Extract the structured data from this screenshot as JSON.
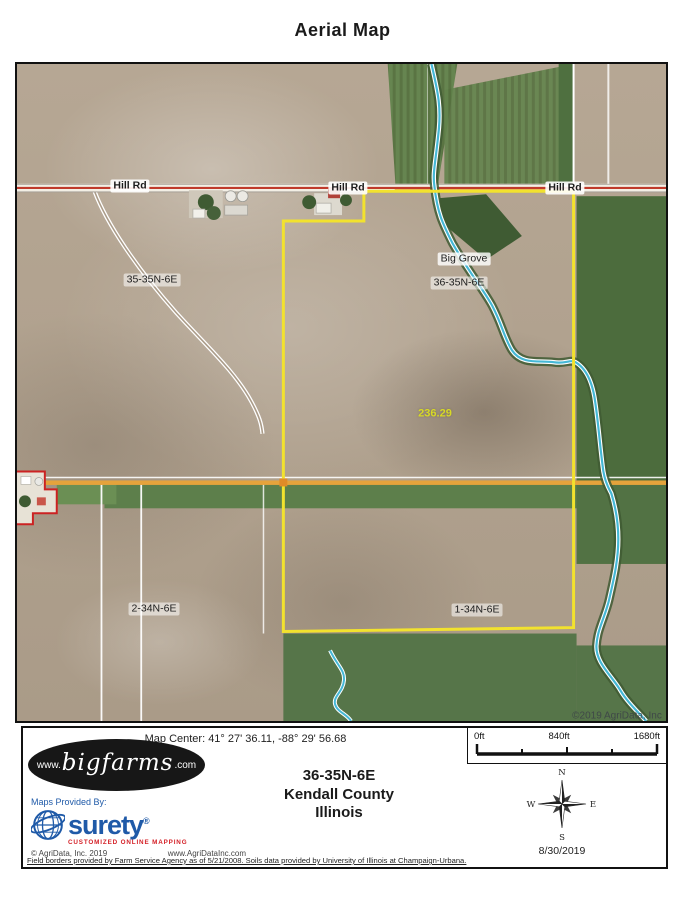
{
  "title": "Aerial Map",
  "colors": {
    "boundary_yellow": "#f2e22e",
    "road_red": "#c03a2b",
    "road_orange": "#e5a33c",
    "water_blue": "#45b8d6",
    "field_green": "#5d7f4b",
    "soil_tan": "#b3a592",
    "acreage_yellow": "#d8d926",
    "brand_blue": "#1f5aa8",
    "brand_red": "#d42027"
  },
  "map": {
    "road_labels": [
      "Hill Rd",
      "Hill Rd",
      "Hill Rd"
    ],
    "labels": {
      "township_nw": "35-35N-6E",
      "place": "Big Grove",
      "township_center": "36-35N-6E",
      "township_sw": "2-34N-6E",
      "township_se": "1-34N-6E"
    },
    "acreage": "236.29",
    "watermark": "©2019 AgriData, Inc"
  },
  "footer": {
    "map_center": "Map Center: 41° 27' 36.11,  -88° 29' 56.68",
    "scale": {
      "ticks": [
        "0ft",
        "840ft",
        "1680ft"
      ]
    },
    "logo": {
      "www": "www.",
      "name": "bigfarms",
      "tld": ".com"
    },
    "location": {
      "line1": "36-35N-6E",
      "line2": "Kendall County",
      "line3": "Illinois"
    },
    "compass": {
      "n": "N",
      "s": "S",
      "e": "E",
      "w": "W"
    },
    "date": "8/30/2019",
    "provider": {
      "label": "Maps Provided By:",
      "brand": "surety",
      "reg": "®",
      "tagline": "CUSTOMIZED ONLINE MAPPING",
      "copyright": "© AgriData, Inc. 2019",
      "website": "www.AgriDataInc.com"
    },
    "disclaimer": "Field borders provided by Farm Service Agency as of 5/21/2008. Soils data provided by University of Illinois at Champaign-Urbana."
  }
}
